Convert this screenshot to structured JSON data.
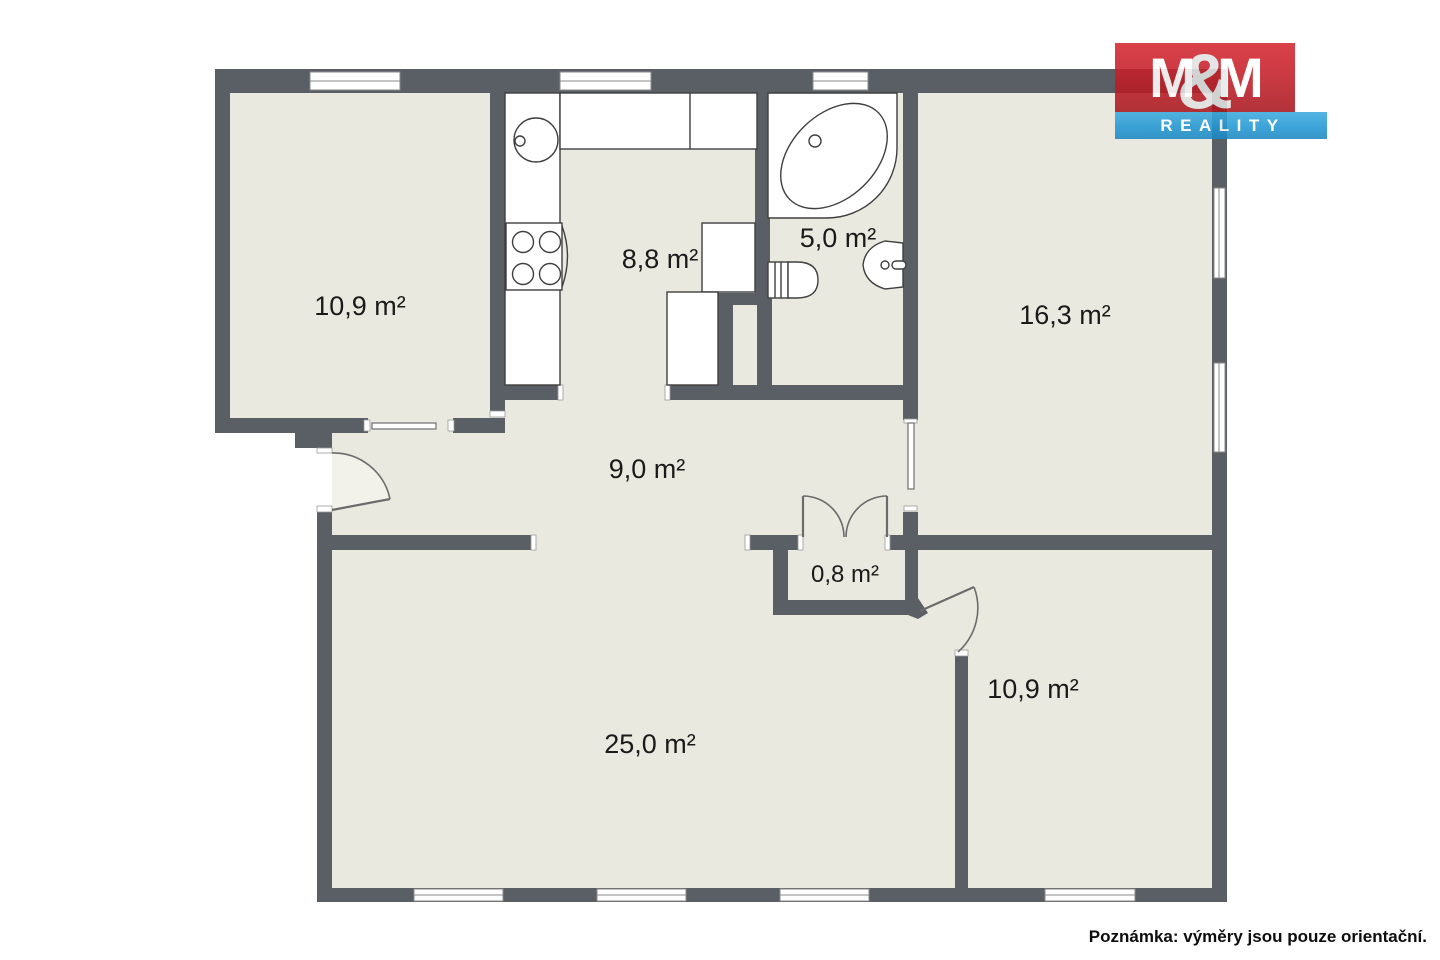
{
  "logo": {
    "m_left": "M",
    "ampersand": "&",
    "m_right": "M",
    "subtitle": "REALITY",
    "red": "#c8232c",
    "blue": "#2b9dd8"
  },
  "note": "Poznámka: výměry jsou pouze orientační.",
  "rooms": [
    {
      "id": "room-top-left",
      "area": "10,9 m²"
    },
    {
      "id": "kitchen",
      "area": "8,8 m²"
    },
    {
      "id": "bathroom",
      "area": "5,0 m²"
    },
    {
      "id": "bedroom-right",
      "area": "16,3 m²"
    },
    {
      "id": "hallway",
      "area": "9,0 m²"
    },
    {
      "id": "closet",
      "area": "0,8 m²"
    },
    {
      "id": "living-room",
      "area": "25,0 m²"
    },
    {
      "id": "bedroom-bottom",
      "area": "10,9 m²"
    }
  ],
  "colors": {
    "wall": "#5a5f66",
    "floor": "#eae9e0",
    "fixture_outline": "#3f3f3f",
    "door_arc": "#6b6b6b",
    "background": "#ffffff"
  }
}
